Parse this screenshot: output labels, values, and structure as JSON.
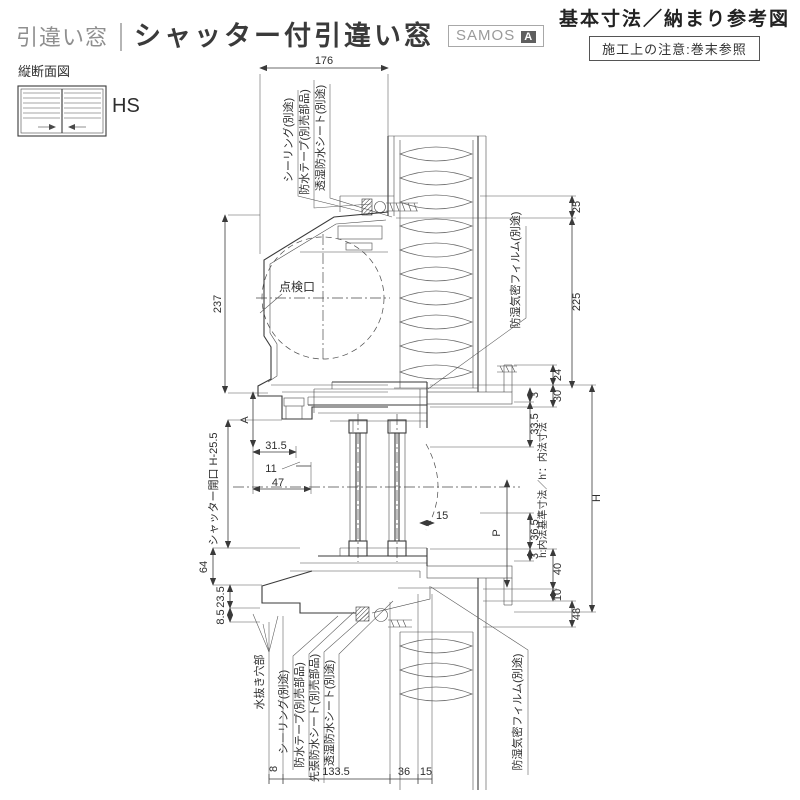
{
  "header": {
    "category": "引違い窓",
    "title": "シャッター付引違い窓",
    "brand": "SAMOS",
    "brand_badge": "A",
    "subtitle": "基本寸法／納まり参考図",
    "note": "施工上の注意:巻末参照"
  },
  "sideview": {
    "label": "縦断面図",
    "type": "HS"
  },
  "drawing": {
    "annotations": {
      "sealing_top": "シーリング(別途)",
      "tape_top": "防水テープ(別売部品)",
      "sheet_top": "透湿防水シート(別途)",
      "film_top": "防湿気密フィルム(別途)",
      "inspection_port": "点検口",
      "shutter_opening": "シャッター開口 H-25.5",
      "inner_note": "h:内法基準寸法／h'：内法寸法",
      "drain_hole": "水抜き穴部",
      "sealing_bottom": "シーリング(別途)",
      "tape_bottom": "防水テープ(別売部品)",
      "pre_sheet_bottom": "先張防水シート(別売部品)",
      "sheet_bottom": "透湿防水シート(別途)",
      "film_bottom": "防湿気密フィルム(別途)"
    },
    "dimensions": {
      "top_width": "176",
      "box_height": "237",
      "dim_a": "A",
      "d31_5": "31.5",
      "d11": "11",
      "d47": "47",
      "d64": "64",
      "d23_5": "23.5",
      "d8_5": "8.5",
      "d25": "25",
      "d225": "225",
      "d24": "24",
      "d30": "30",
      "d3_top": "3",
      "d33_5": "33.5",
      "p": "P",
      "d36_5": "36.5",
      "d3_bottom": "3",
      "d40": "40",
      "d10": "10",
      "h": "H",
      "d48": "48",
      "d15_mid": "15",
      "b8": "8",
      "b133_5": "133.5",
      "b36": "36",
      "b15": "15"
    }
  }
}
